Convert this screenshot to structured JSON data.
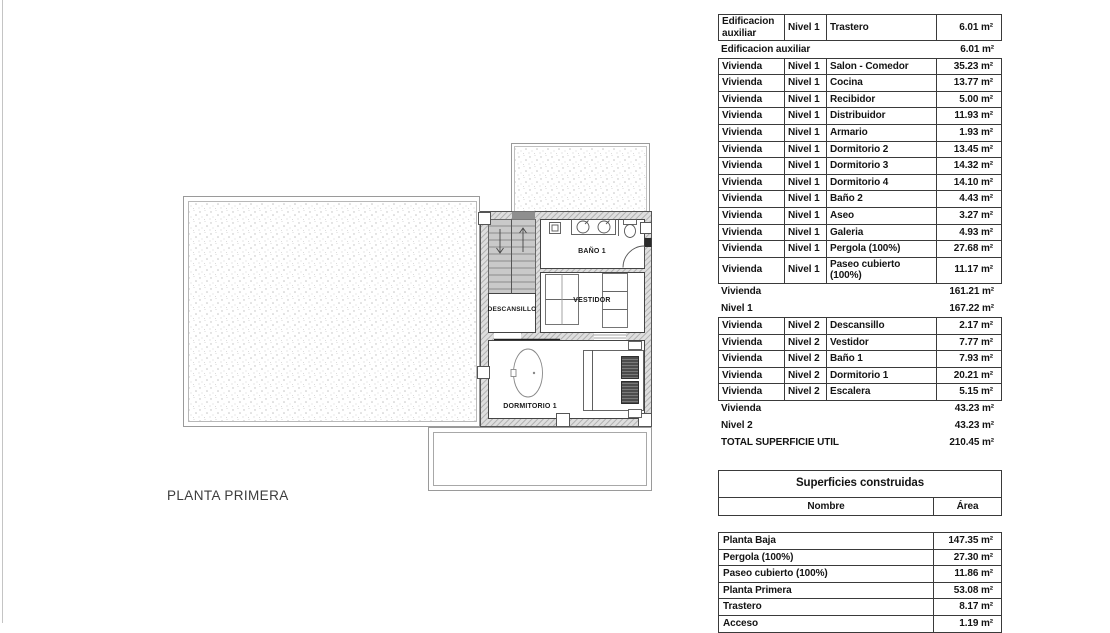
{
  "plan": {
    "title": "PLANTA PRIMERA",
    "room_labels": {
      "descansillo": "DESCANSILLO",
      "bano1": "BAÑO 1",
      "vestidor": "VESTIDOR",
      "dormitorio1": "DORMITORIO 1"
    }
  },
  "surfaces_util_table": {
    "segments": [
      {
        "type": "grid",
        "rows": [
          [
            "Edificacion auxiliar",
            "Nivel 1",
            "Trastero",
            "6.01 m²"
          ]
        ]
      },
      {
        "type": "summary",
        "rows": [
          [
            "Edificacion auxiliar",
            "6.01 m²"
          ]
        ]
      },
      {
        "type": "grid",
        "rows": [
          [
            "Vivienda",
            "Nivel 1",
            "Salon - Comedor",
            "35.23 m²"
          ],
          [
            "Vivienda",
            "Nivel 1",
            "Cocina",
            "13.77 m²"
          ],
          [
            "Vivienda",
            "Nivel 1",
            "Recibidor",
            "5.00 m²"
          ],
          [
            "Vivienda",
            "Nivel 1",
            "Distribuidor",
            "11.93 m²"
          ],
          [
            "Vivienda",
            "Nivel 1",
            "Armario",
            "1.93 m²"
          ],
          [
            "Vivienda",
            "Nivel 1",
            "Dormitorio 2",
            "13.45 m²"
          ],
          [
            "Vivienda",
            "Nivel 1",
            "Dormitorio 3",
            "14.32 m²"
          ],
          [
            "Vivienda",
            "Nivel 1",
            "Dormitorio 4",
            "14.10 m²"
          ],
          [
            "Vivienda",
            "Nivel 1",
            "Baño 2",
            "4.43 m²"
          ],
          [
            "Vivienda",
            "Nivel 1",
            "Aseo",
            "3.27 m²"
          ],
          [
            "Vivienda",
            "Nivel 1",
            "Galeria",
            "4.93 m²"
          ],
          [
            "Vivienda",
            "Nivel 1",
            "Pergola (100%)",
            "27.68 m²"
          ],
          [
            "Vivienda",
            "Nivel 1",
            "Paseo cubierto (100%)",
            "11.17 m²"
          ]
        ]
      },
      {
        "type": "summary",
        "rows": [
          [
            "Vivienda",
            "161.21 m²"
          ],
          [
            "Nivel 1",
            "167.22 m²"
          ]
        ]
      },
      {
        "type": "grid",
        "rows": [
          [
            "Vivienda",
            "Nivel 2",
            "Descansillo",
            "2.17 m²"
          ],
          [
            "Vivienda",
            "Nivel 2",
            "Vestidor",
            "7.77 m²"
          ],
          [
            "Vivienda",
            "Nivel 2",
            "Baño 1",
            "7.93 m²"
          ],
          [
            "Vivienda",
            "Nivel 2",
            "Dormitorio 1",
            "20.21 m²"
          ],
          [
            "Vivienda",
            "Nivel 2",
            "Escalera",
            "5.15 m²"
          ]
        ]
      },
      {
        "type": "summary",
        "rows": [
          [
            "Vivienda",
            "43.23 m²"
          ],
          [
            "Nivel 2",
            "43.23 m²"
          ],
          [
            "TOTAL SUPERFICIE UTIL",
            "210.45 m²"
          ]
        ]
      }
    ]
  },
  "superficies_construidas": {
    "title": "Superficies construidas",
    "columns": [
      "Nombre",
      "Área"
    ],
    "rows": [
      [
        "Planta Baja",
        "147.35 m²"
      ],
      [
        "Pergola (100%)",
        "27.30 m²"
      ],
      [
        "Paseo cubierto (100%)",
        "11.86 m²"
      ],
      [
        "Planta Primera",
        "53.08 m²"
      ],
      [
        "Trastero",
        "8.17 m²"
      ],
      [
        "Acceso",
        "1.19 m²"
      ]
    ]
  }
}
